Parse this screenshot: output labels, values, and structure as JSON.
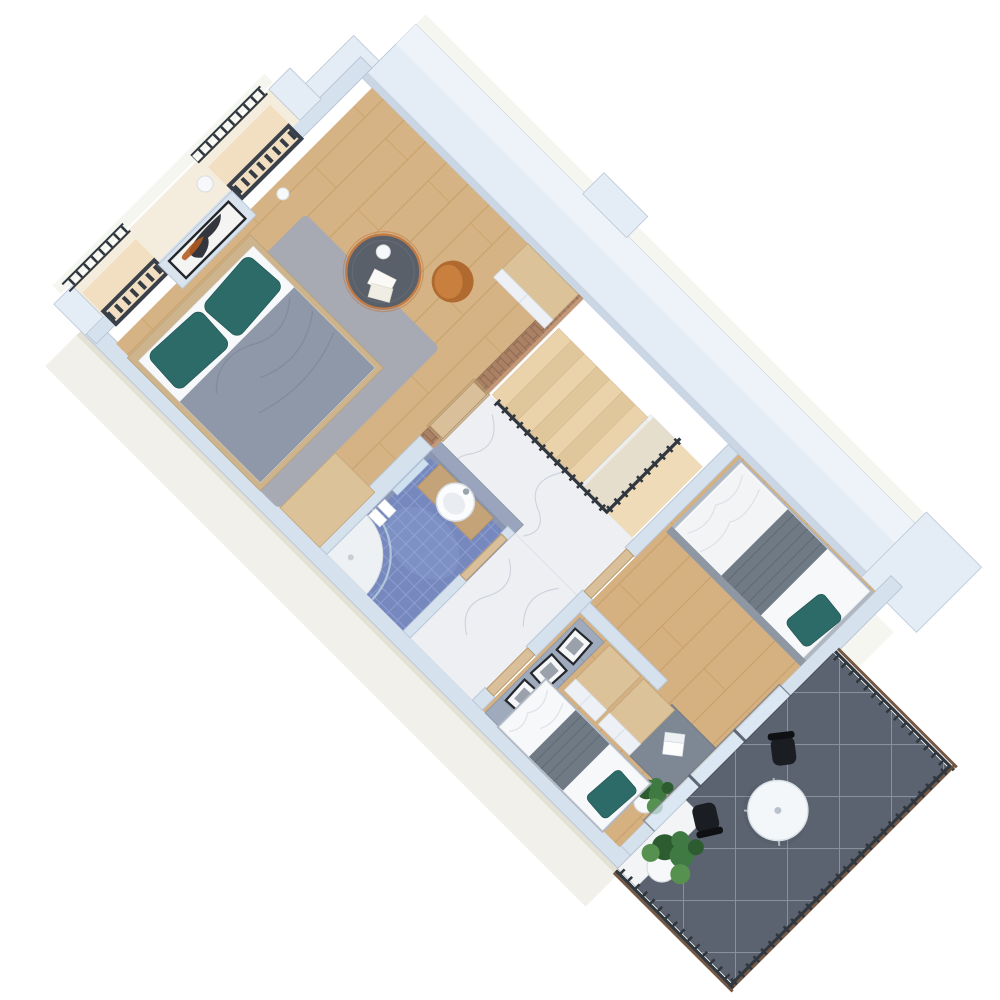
{
  "scene": {
    "title": "3D axonometric floor plan render, upper storey of an apartment",
    "view": "top-down rotated roughly 45 degrees, white background",
    "background": "#ffffff"
  },
  "palette": {
    "wall": "#d6e1ee",
    "wallLight": "#e4ecf5",
    "wallTop": "#eef3f9",
    "wallLip": "#c2cfde",
    "wallEdge": "#b9c7d8",
    "wallOuter": "#f1f0ea",
    "wallOuterEdge": "#e4e2d4",
    "woodBase": "#d6b384",
    "woodLine": "#c19a63",
    "woodSeam": "#c9a267",
    "stairWood": "#ead2ab",
    "stairWoodDark": "#e0c69b",
    "landingWood": "#eed9b4",
    "marble": "#edeff3",
    "marbleVein": "#c8ccd6",
    "brick": "#aa8165",
    "brickLine": "#8f6a50",
    "brickLight": "#c89e7e",
    "mosaic": "#7688bd",
    "mosaicLine": "#95a7d8",
    "tileWall": "#9aa5bd",
    "terraceTile": "#5a636f",
    "terraceLine": "#8f98a4",
    "railDark": "#30373f",
    "railWoodTrim": "#6d4f3a",
    "teal": "#2d6b69",
    "tealDark": "#245856",
    "duvet": "#8e98a8",
    "duvetLine": "#7d8696",
    "blanket": "#6f7a85",
    "blanketLine": "#5d6772",
    "rug": "#a4aab5",
    "bedFrame": "#cdb48c",
    "matWhite": "#f7f8fa",
    "sheetLine": "#dcdfe4",
    "orange": "#c9803f",
    "orangeDark": "#b06a2f",
    "tableTop": "#596069",
    "copper": "#bf7a45",
    "cabWhite": "#edf1f5",
    "cabSeam": "#d6dce3",
    "woodTop": "#dcc298",
    "graycab": "#9fabbd",
    "graycabLine": "#8c97a8",
    "deskGray": "#7e8894",
    "deskEdge": "#6f7884",
    "doorWood": "#d9c09a",
    "doorEdge": "#b89b6f",
    "frameDark": "#23262b",
    "artOrange": "#b35a1f",
    "artDark": "#22262e",
    "plant": "#3e7a42",
    "plantDark": "#2e5c31",
    "plantLight": "#579150",
    "potWhite": "#f6f8f9",
    "glassBlue": "#cfdfee",
    "glow": "#f7ead6",
    "balconyFloor": "#f4ecdc",
    "chairBlack": "#1a1d21",
    "tableWhite": "#f3f7fa",
    "shadow": "#39404a"
  },
  "rooms": [
    {
      "id": "master-bedroom",
      "name": "Master bedroom",
      "floor": "light oak plank"
    },
    {
      "id": "stairwell",
      "name": "Stairwell void",
      "floor": "open void with wooden winder stairs and dark railing"
    },
    {
      "id": "hallway",
      "name": "Hallway / landing",
      "floor": "white marble"
    },
    {
      "id": "bathroom",
      "name": "Bathroom",
      "floor": "blue mosaic tile"
    },
    {
      "id": "bedroom-2",
      "name": "Bedroom 2",
      "floor": "light oak plank"
    },
    {
      "id": "bedroom-3",
      "name": "Bedroom 3",
      "floor": "light oak plank"
    },
    {
      "id": "juliet-balcony",
      "name": "Juliet balcony",
      "floor": "sunlit concrete slab"
    },
    {
      "id": "terrace",
      "name": "Terrace",
      "floor": "dark slate tile with light grout"
    }
  ],
  "furniture": {
    "master_bedroom": [
      "double bed with gray duvet and two teal pillows",
      "gray rug",
      "orange armchair",
      "round coffee table with copper base, sphere lamp and magazines",
      "wood-top white dresser",
      "wooden sideboard",
      "abstract wall art in black frame",
      "white vase"
    ],
    "bathroom": [
      "round white basin on wooden shelf",
      "corner shower with glass screen",
      "radiator",
      "white towels"
    ],
    "hallway": [
      "wooden doors to all rooms",
      "marble floor"
    ],
    "stairwell": [
      "wooden winder stairs",
      "dark steel railing with glass panel",
      "brick accent wall"
    ],
    "bedroom_2": [
      "single bed with striped gray blanket and teal pillow",
      "gray desk with white laptop",
      "teal desk chair",
      "potted plant",
      "sliding glass door to terrace"
    ],
    "bedroom_3": [
      "single bed with striped gray blanket and teal pillow",
      "two wood-top white wardrobes",
      "gray drawer sideboard with three framed pictures"
    ],
    "terrace": [
      "round white bistro table",
      "two black chairs",
      "large potted plant",
      "dark metal railing with wood trim"
    ],
    "juliet_balcony": [
      "dark railings with balusters",
      "white plant pot"
    ]
  }
}
